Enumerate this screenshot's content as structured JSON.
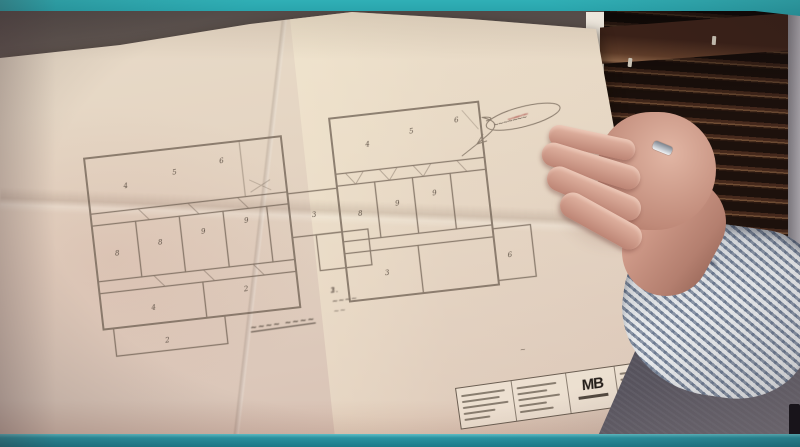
{
  "frame": {
    "accent_top_bar_color": "#2caab1",
    "accent_bottom_bar_color": "#1d7f8f"
  },
  "photo": {
    "plan": {
      "room_marks": [
        "4",
        "5",
        "6",
        "8",
        "8",
        "9",
        "9",
        "4",
        "2",
        "2",
        "3",
        "4",
        "5",
        "6",
        "8",
        "9",
        "9",
        "3",
        "6"
      ]
    },
    "annotations": {
      "callout_scribble": "~~~~~~~",
      "red_note_lines": [
        "~~",
        "~~~",
        "~~"
      ],
      "spec_list": [
        "1. ~~~~ ~~",
        "2. ~~~",
        "3. ~~~~"
      ],
      "underlined_label": "~~~~ ~~~~",
      "tiny_mark": "~"
    },
    "title_block": {
      "logo": "MB"
    }
  }
}
